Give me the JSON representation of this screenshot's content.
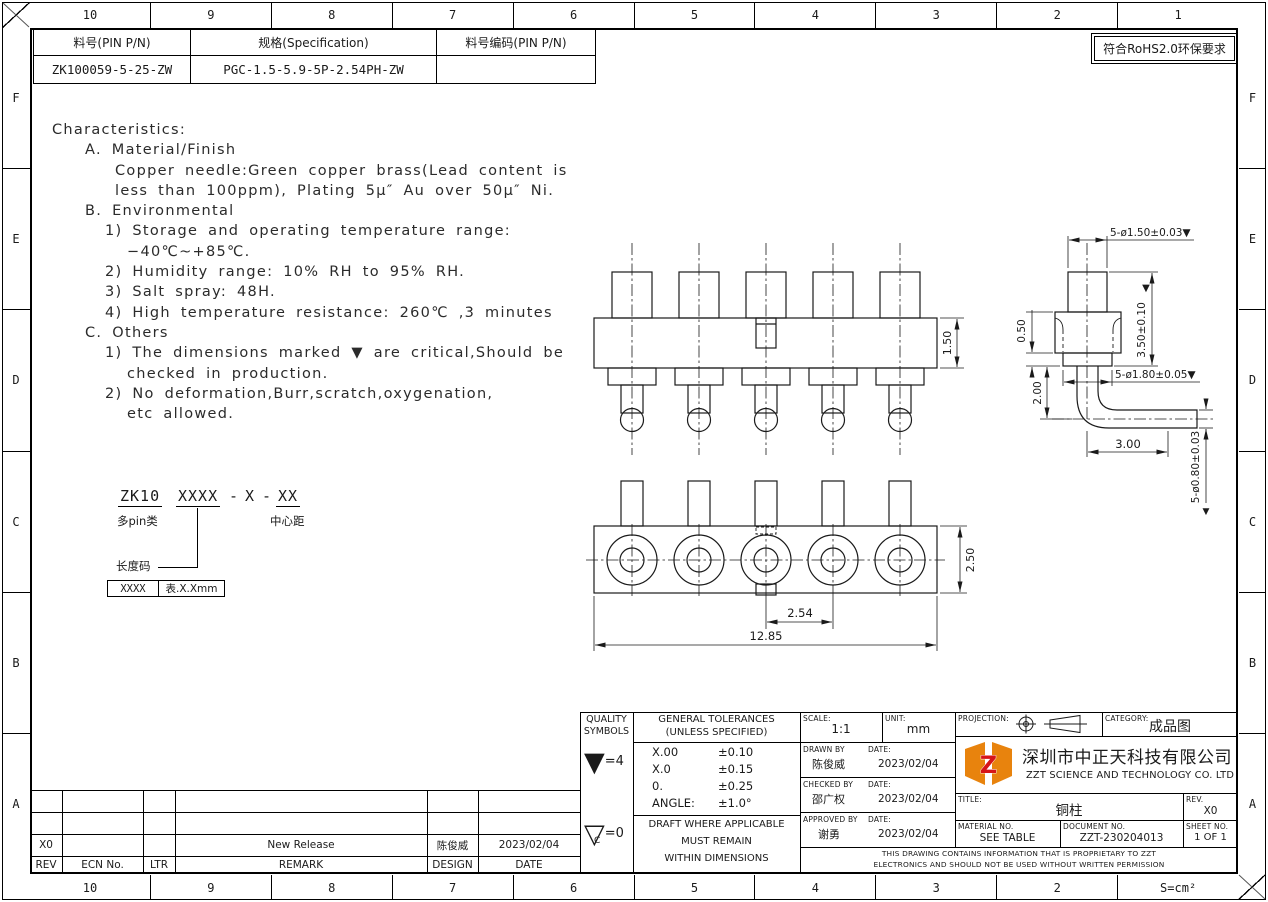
{
  "sheet": {
    "rohs_note": "符合RoHS2.0环保要求",
    "zones": {
      "top": [
        "10",
        "9",
        "8",
        "7",
        "6",
        "5",
        "4",
        "3",
        "2",
        "1"
      ],
      "bottom": [
        "10",
        "9",
        "8",
        "7",
        "6",
        "5",
        "4",
        "3",
        "2",
        "S=cm²"
      ],
      "left": [
        "F",
        "E",
        "D",
        "C",
        "B",
        "A"
      ],
      "right": [
        "F",
        "E",
        "D",
        "C",
        "B",
        "A"
      ]
    }
  },
  "header_table": {
    "pn_label": "料号(PIN P/N)",
    "spec_label": "规格(Specification)",
    "code_label": "料号编码(PIN P/N)",
    "pn_value": "ZK100059-5-25-ZW",
    "spec_value": "PGC-1.5-5.9-5P-2.54PH-ZW",
    "code_value": ""
  },
  "characteristics": {
    "lines": [
      "Characteristics:",
      "A. Material/Finish",
      "Copper needle:Green copper brass(Lead content is",
      "less than 100ppm), Plating 5µ″ Au over 50µ″ Ni.",
      "B. Environmental",
      "1) Storage and operating temperature range:",
      "−40℃~+85℃.",
      "2) Humidity range: 10% RH to 95% RH.",
      "3) Salt spray: 48H.",
      "4) High temperature resistance: 260℃ ,3 minutes",
      "C. Others",
      "1) The dimensions marked ▼ are critical,Should be",
      "checked in production.",
      "2) No deformation,Burr,scratch,oxygenation,",
      "etc allowed."
    ]
  },
  "part_code": {
    "seg_family": "ZK10",
    "seg_length": "XXXX",
    "dash1": "-",
    "seg_mid": "X",
    "dash2": "-",
    "seg_pitch": "XX",
    "family_label": "多pin类",
    "pitch_label": "中心距",
    "length_label": "长度码",
    "table_key": "XXXX",
    "table_value": "表.X.Xmm"
  },
  "dims": {
    "h150": "1.50",
    "h250": "2.50",
    "p254": "2.54",
    "w1285": "12.85",
    "d150": "5-ø1.50±0.03▼",
    "h350": "3.50±0.10",
    "h050": "0.50",
    "h200": "2.00",
    "d180": "5-ø1.80±0.05▼",
    "w300": "3.00",
    "d080": "5-ø0.80±0.03",
    "mark": "▼"
  },
  "title_block": {
    "quality": {
      "line1": "QUALITY",
      "line2": "SYMBOLS",
      "critical_symbol": "▼",
      "critical_eq": "=4",
      "minor_symbol": "▽",
      "minor_letter": "C",
      "minor_eq": "=0"
    },
    "tolerances": {
      "line1": "GENERAL TOLERANCES",
      "line2": "(UNLESS SPECIFIED)",
      "rows": [
        [
          "X.00",
          "±0.10"
        ],
        [
          "X.0",
          "±0.15"
        ],
        [
          "0.",
          "±0.25"
        ],
        [
          "ANGLE:",
          "±1.0°"
        ]
      ],
      "note1": "DRAFT WHERE APPLICABLE",
      "note2": "MUST REMAIN",
      "note3": "WITHIN DIMENSIONS"
    },
    "approvals": {
      "scale_label": "SCALE:",
      "scale": "1:1",
      "unit_label": "UNIT:",
      "unit": "mm",
      "date_label": "DATE:",
      "drawn_label": "DRAWN BY",
      "drawn_name": "陈俊威",
      "drawn_date": "2023/02/04",
      "checked_label": "CHECKED BY",
      "checked_name": "邵广权",
      "checked_date": "2023/02/04",
      "approved_label": "APPROVED BY",
      "approved_name": "谢勇",
      "approved_date": "2023/02/04"
    },
    "company": {
      "projection_label": "PROJECTION:",
      "category_label": "CATEGORY:",
      "category": "成品图",
      "logo_letter": "Z",
      "name_cn": "深圳市中正天科技有限公司",
      "name_en": "ZZT SCIENCE AND TECHNOLOGY CO. LTD",
      "title_label": "TITLE:",
      "title": "铜柱",
      "rev_label": "REV.",
      "rev": "X0",
      "material_label": "MATERIAL NO.",
      "material": "SEE TABLE",
      "doc_label": "DOCUMENT NO.",
      "doc_no": "ZZT-230204013",
      "sheet_label": "SHEET NO.",
      "sheet": "1 OF 1",
      "proprietary1": "THIS DRAWING CONTAINS INFORMATION THAT IS PROPRIETARY TO ZZT",
      "proprietary2": "ELECTRONICS AND SHOULD NOT BE USED WITHOUT WRITTEN PERMISSION"
    }
  },
  "revision_table": {
    "headers": [
      "REV",
      "ECN No.",
      "LTR",
      "REMARK",
      "DESIGN",
      "DATE"
    ],
    "row": {
      "rev": "X0",
      "ecn": "",
      "ltr": "",
      "remark": "New Release",
      "design": "陈俊威",
      "date": "2023/02/04"
    }
  },
  "colors": {
    "logo_orange": "#e8830d",
    "logo_red": "#d61518",
    "line": "#1a1a1a"
  }
}
